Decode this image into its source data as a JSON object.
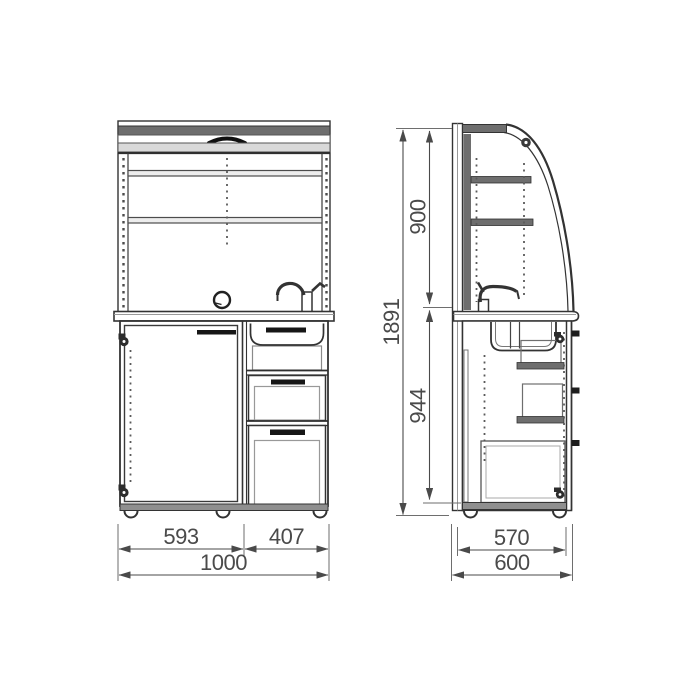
{
  "drawing": {
    "description": "Technical drawing of a sink cabinet with roller-shutter top: front view and side view"
  },
  "dimensions": {
    "front_door_width": "593",
    "front_drawers_width": "407",
    "front_total_width": "1000",
    "upper_section_height": "900",
    "base_section_height": "944",
    "overall_height": "1891",
    "side_body_depth": "570",
    "side_total_depth": "600"
  }
}
